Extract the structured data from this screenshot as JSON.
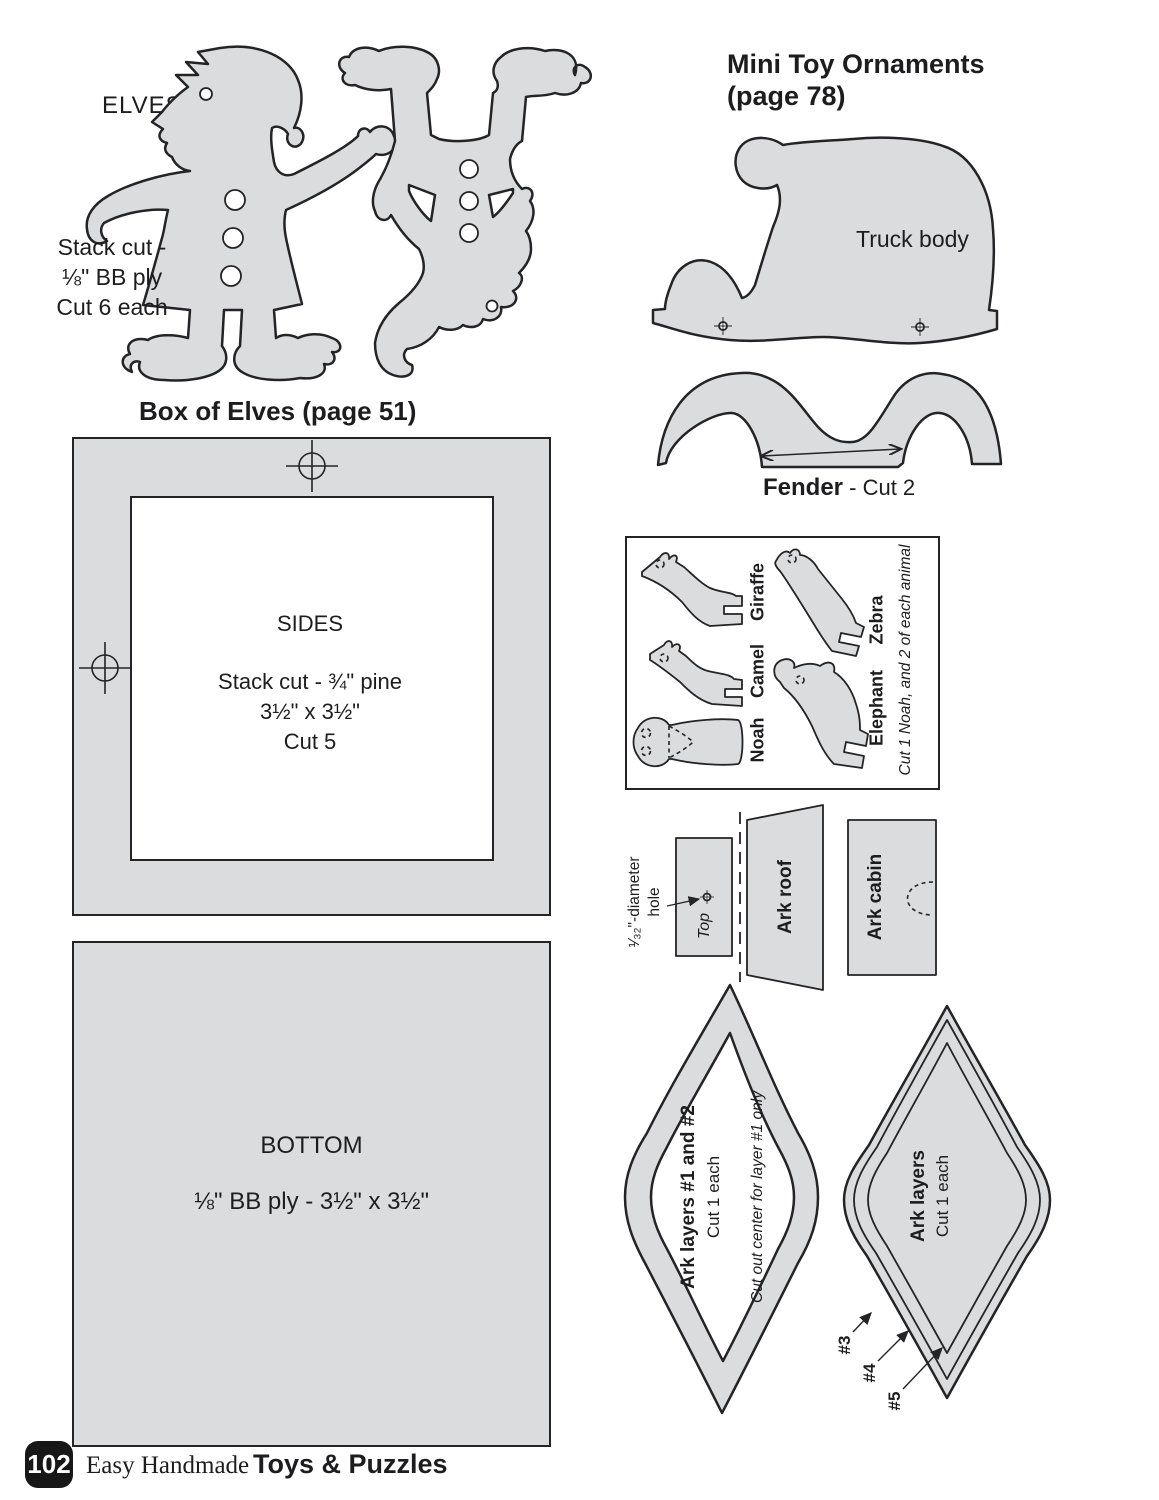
{
  "colors": {
    "shape_fill": "#dbdcde",
    "outline": "#242325",
    "text": "#1d1d1f"
  },
  "elves": {
    "label": "ELVES",
    "note_line1": "Stack cut -",
    "note_line2": "⅛\" BB ply",
    "note_line3": "Cut 6 each"
  },
  "box_of_elves": {
    "heading": "Box of Elves (page 51)",
    "sides_title": "SIDES",
    "sides_line1": "Stack cut - ¾\" pine",
    "sides_line2": "3½\" x 3½\"",
    "sides_line3": "Cut 5",
    "bottom_title": "BOTTOM",
    "bottom_line1": "⅛\" BB ply - 3½\" x 3½\""
  },
  "mini_toy": {
    "heading_line1": "Mini Toy Ornaments",
    "heading_line2": "(page 78)",
    "truck_body_label": "Truck body",
    "fender_label": "Fender",
    "fender_cut": " - Cut 2"
  },
  "ark": {
    "animals": {
      "noah": "Noah",
      "camel": "Camel",
      "giraffe": "Giraffe",
      "elephant": "Elephant",
      "zebra": "Zebra",
      "caption": "Cut 1 Noah, and 2 of each animal"
    },
    "hole_note_line1": "¹⁄₃₂\"-diameter",
    "hole_note_line2": "hole",
    "top_label": "Top",
    "roof_label": "Ark roof",
    "cabin_label": "Ark cabin",
    "layers12_title": "Ark layers #1 and #2",
    "layers12_cut": "Cut 1 each",
    "layers12_note": "Cut out center for layer #1 only",
    "layers_title": "Ark layers",
    "layers_cut": "Cut 1 each",
    "tag3": "#3",
    "tag4": "#4",
    "tag5": "#5"
  },
  "footer": {
    "page_number": "102",
    "series": "Easy Handmade",
    "title": "Toys & Puzzles"
  }
}
